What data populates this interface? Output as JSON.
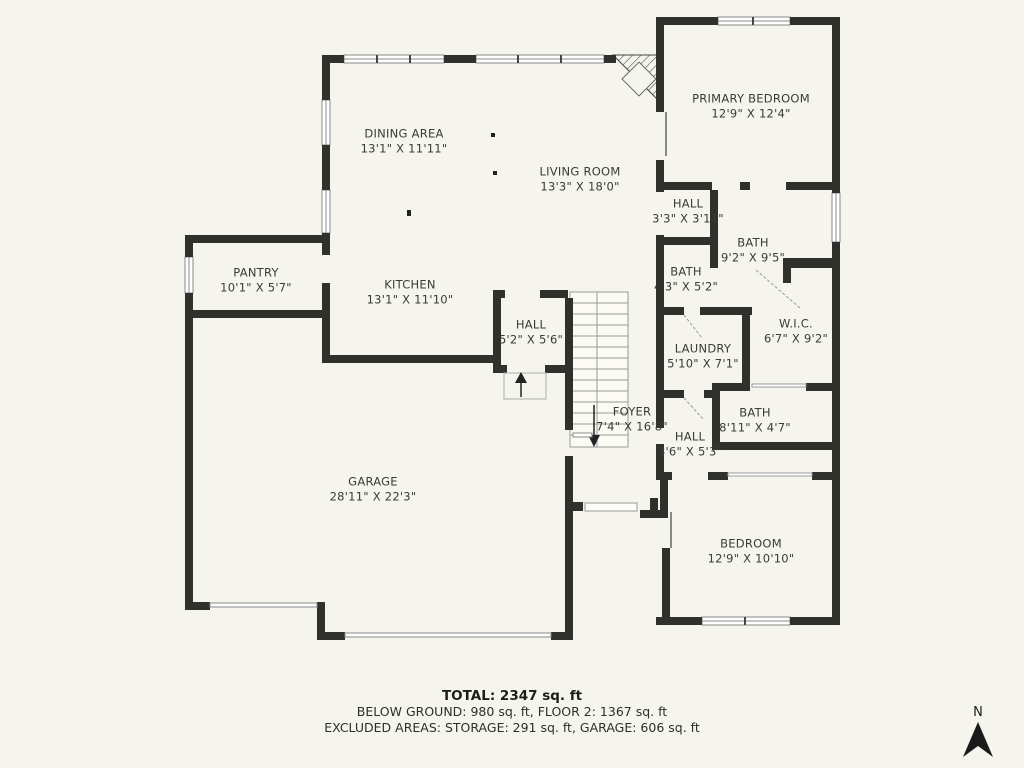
{
  "plan": {
    "rooms": {
      "dining": {
        "name": "DINING AREA",
        "dims": "13'1\" X 11'11\""
      },
      "living": {
        "name": "LIVING ROOM",
        "dims": "13'3\" X 18'0\""
      },
      "primary_bedroom": {
        "name": "PRIMARY BEDROOM",
        "dims": "12'9\" X 12'4\""
      },
      "hall_upper": {
        "name": "HALL",
        "dims": "3'3\" X 3'11\""
      },
      "bath_primary": {
        "name": "BATH",
        "dims": "9'2\" X 9'5\""
      },
      "bath_small": {
        "name": "BATH",
        "dims": "4'3\" X 5'2\""
      },
      "pantry": {
        "name": "PANTRY",
        "dims": "10'1\" X 5'7\""
      },
      "kitchen": {
        "name": "KITCHEN",
        "dims": "13'1\" X 11'10\""
      },
      "hall_mid": {
        "name": "HALL",
        "dims": "5'2\" X 5'6\""
      },
      "wic": {
        "name": "W.I.C.",
        "dims": "6'7\" X 9'2\""
      },
      "laundry": {
        "name": "LAUNDRY",
        "dims": "5'10\" X 7'1\""
      },
      "foyer": {
        "name": "FOYER",
        "dims": "7'4\" X 16'8\""
      },
      "bath_hall": {
        "name": "BATH",
        "dims": "8'11\" X 4'7\""
      },
      "hall_lower": {
        "name": "HALL",
        "dims": "3'6\" X 5'3\""
      },
      "garage": {
        "name": "GARAGE",
        "dims": "28'11\" X 22'3\""
      },
      "bedroom": {
        "name": "BEDROOM",
        "dims": "12'9\" X 10'10\""
      }
    },
    "footer": {
      "total": "TOTAL: 2347 sq. ft",
      "floors": "BELOW GROUND: 980 sq. ft, FLOOR 2: 1367 sq. ft",
      "excluded": "EXCLUDED AREAS: STORAGE: 291 sq. ft, GARAGE: 606 sq. ft"
    },
    "compass": {
      "label": "N"
    },
    "colors": {
      "background": "#F5F5EE",
      "wall": "#30302C",
      "text": "#3B3B38"
    }
  }
}
